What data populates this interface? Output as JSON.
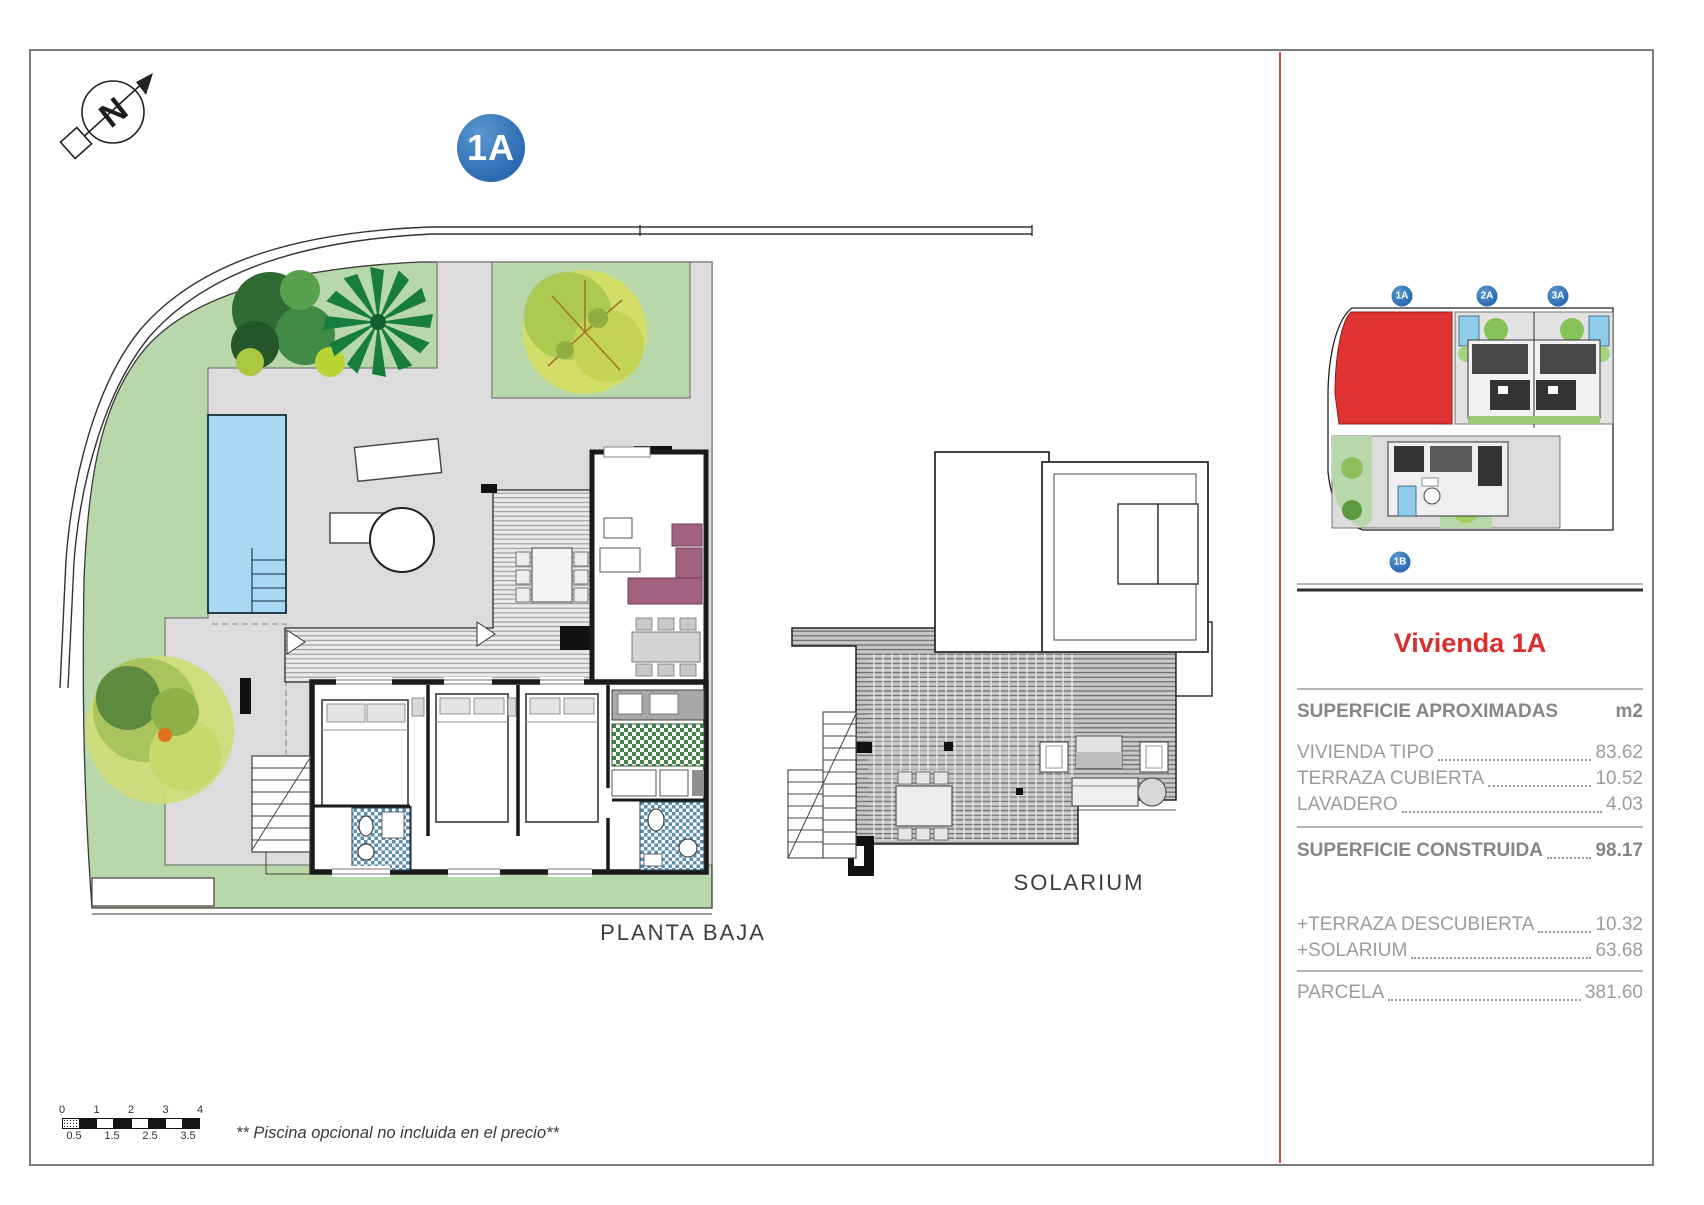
{
  "compass": {
    "letter": "N"
  },
  "badge": {
    "label": "1A"
  },
  "plan": {
    "label": "PLANTA BAJA"
  },
  "solarium": {
    "label": "SOLARIUM"
  },
  "note": "** Piscina opcional no incluida en el precio**",
  "scalebar": {
    "top": [
      "0",
      "1",
      "2",
      "3",
      "4"
    ],
    "bottom": [
      "0.5",
      "1.5",
      "2.5",
      "3.5"
    ]
  },
  "panel": {
    "map_badges": [
      {
        "label": "1A"
      },
      {
        "label": "2A"
      },
      {
        "label": "3A"
      },
      {
        "label": "1B"
      }
    ],
    "title": "Vivienda 1A",
    "table": {
      "header": {
        "label": "SUPERFICIE APROXIMADAS",
        "unit": "m2"
      },
      "rows": [
        {
          "label": "VIVIENDA TIPO",
          "value": "83.62"
        },
        {
          "label": "TERRAZA CUBIERTA",
          "value": "10.52"
        },
        {
          "label": "LAVADERO",
          "value": "4.03"
        }
      ],
      "construida": {
        "label": "SUPERFICIE CONSTRUIDA",
        "value": "98.17"
      },
      "extras": [
        {
          "label": "+TERRAZA DESCUBIERTA",
          "value": "10.32"
        },
        {
          "label": "+SOLARIUM",
          "value": "63.68"
        }
      ],
      "parcela": {
        "label": "PARCELA",
        "value": "381.60"
      }
    }
  },
  "colors": {
    "accent_red": "#d92f2f",
    "badge_blue": "#2e6fb7",
    "parcel_red": "#e23333",
    "pool_blue": "#a9d9f2",
    "lawn_green": "#b8d7aa"
  }
}
